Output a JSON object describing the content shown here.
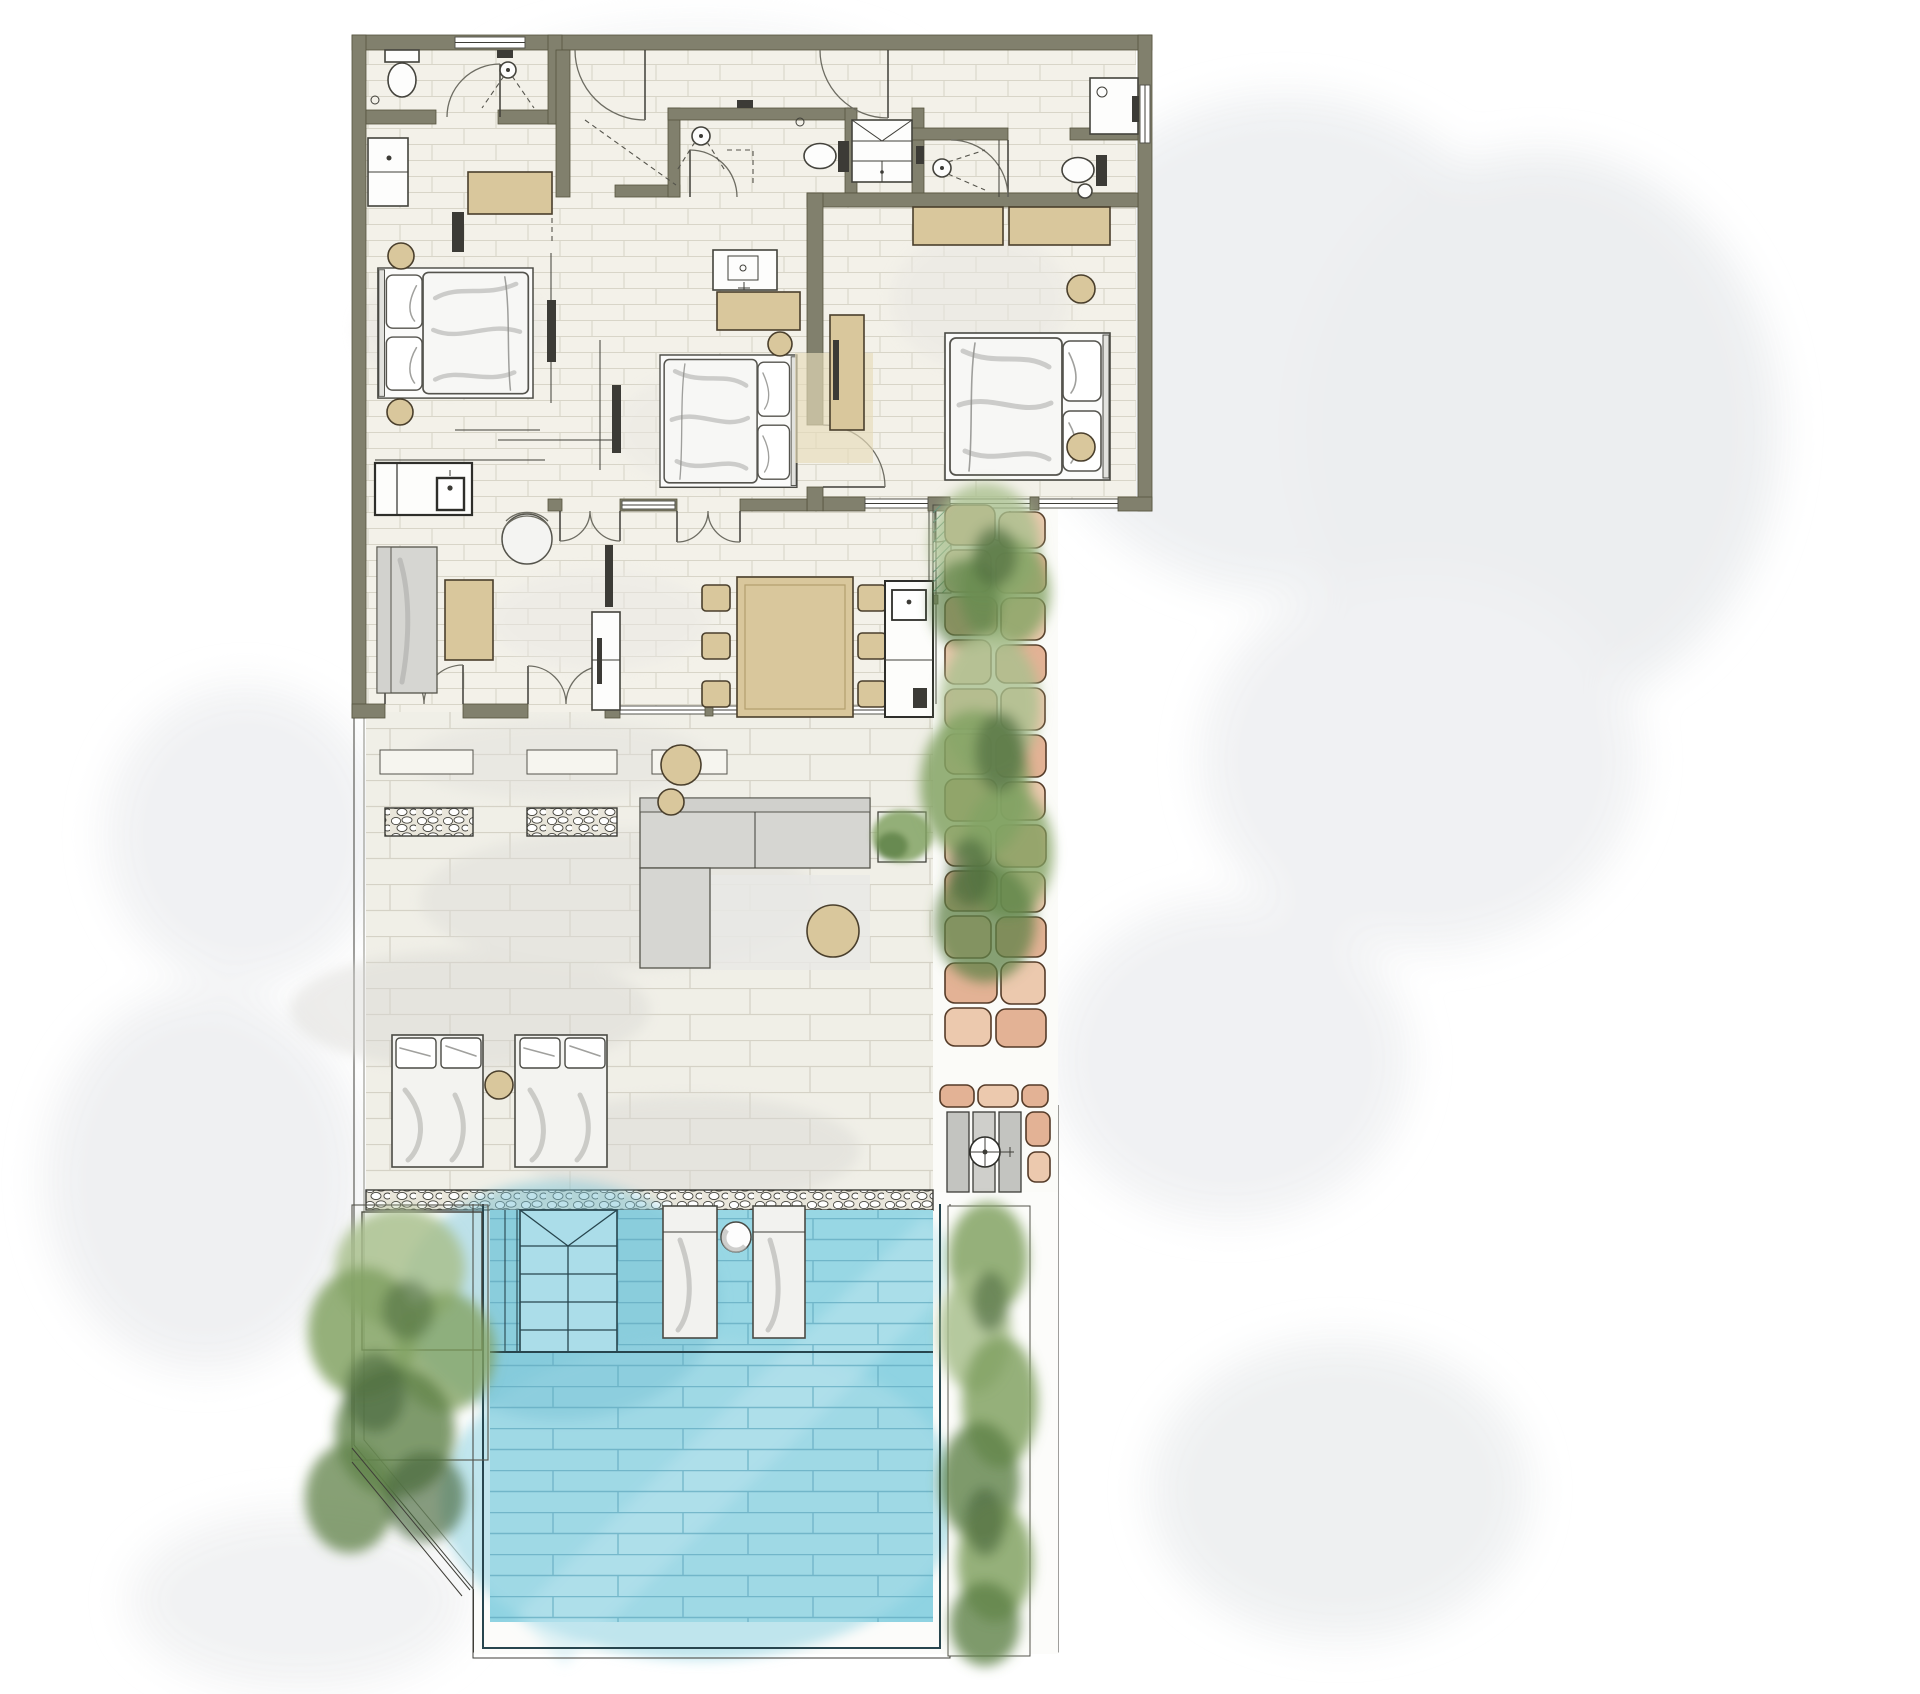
{
  "scene": {
    "type": "architectural-floor-plan",
    "style": "hand-rendered watercolor",
    "view": "top-down plan of a pool villa"
  },
  "colors": {
    "paper": "#ffffff",
    "wash": "#eef0f2",
    "wall": "#81806d",
    "wallEdge": "#55543f",
    "line": "#3f3e38",
    "floor": "#f3f1e9",
    "grout": "#d8d5c8",
    "terrace": "#f0efe7",
    "deck": "#fcfcfa",
    "tan": "#d9c79c",
    "tanLight": "#e7dcba",
    "pool": "#8fd3e2",
    "poolShelf": "#9ad8e5",
    "poolGrout": "#62abc0",
    "poolLine": "#27454e",
    "pebbleBg": "#e9e6db",
    "brick": "#e3b295",
    "brickLight": "#ecc9ae",
    "brickEdge": "#553b28",
    "green1": "#a9bf8d",
    "green2": "#82a263",
    "green3": "#5f8148",
    "green4": "#47663a",
    "hatchTeal": "#4e8b7a",
    "sketchGray": "#a9a9a6"
  },
  "rooms": [
    {
      "id": "bedroom-1",
      "position": "top-left",
      "furniture": [
        "double-bed",
        "bedside-stool",
        "bedside-stool",
        "wardrobe",
        "vanity",
        "tv-panel"
      ]
    },
    {
      "id": "bedroom-2",
      "position": "top-middle",
      "furniture": [
        "double-bed",
        "bedside-stool",
        "vanity-with-sink",
        "wardrobe-cabinet",
        "tv-panel"
      ]
    },
    {
      "id": "bedroom-3",
      "position": "top-right",
      "furniture": [
        "double-bed",
        "bedside-stool",
        "bedside-stool",
        "wardrobe",
        "wardrobe",
        "desk",
        "rug"
      ]
    },
    {
      "id": "bathroom-1",
      "position": "top-left",
      "fixtures": [
        "toilet",
        "shower",
        "swing-door"
      ]
    },
    {
      "id": "bathroom-2",
      "position": "top-middle",
      "fixtures": [
        "toilet",
        "shower",
        "swing-door",
        "linen-closet"
      ]
    },
    {
      "id": "bathroom-3",
      "position": "top-right",
      "fixtures": [
        "toilet",
        "shower",
        "hand-basin",
        "corner-vanity",
        "swing-door"
      ]
    },
    {
      "id": "entry-hall",
      "doors": [
        "entry-door-left",
        "entry-door-right"
      ]
    },
    {
      "id": "living-room",
      "furniture": [
        "sofa",
        "coffee-table",
        "round-armchair",
        "kitchenette-with-sink",
        "media-unit",
        "french-doors",
        "french-doors"
      ]
    },
    {
      "id": "dining-area",
      "furniture": [
        "dining-table",
        "dining-chairs-x6",
        "outdoor-kitchen-counter-with-sink",
        "glazed-wall"
      ]
    }
  ],
  "outdoor": {
    "terrace": [
      "paver-floor",
      "pebble-inlay-band-x3",
      "l-shaped-lounge-sofa",
      "lounge-rug",
      "round-side-table-x3",
      "planter-box",
      "double-sun-lounger-x2",
      "lounger-side-table"
    ],
    "garden_right": [
      "stone-brick-path",
      "shrub-watercolor-cluster-x2",
      "hatched-planting-bed",
      "outdoor-shower-3-slats",
      "shower-rose"
    ],
    "garden_left": [
      "tree-watercolor-cluster",
      "planter-border",
      "diagonal-site-boundary"
    ],
    "pool": {
      "water_color": "#8fd3e2",
      "features": [
        "corner-steps-with-triangle",
        "four-treads",
        "sun-shelf-line",
        "in-pool-lounger-x2",
        "float-ball",
        "tiled-bottom",
        "double-coping-line"
      ],
      "hedge_right": "watercolor-hedge-strip"
    }
  },
  "counts": {
    "beds": 3,
    "toilets": 3,
    "showers": 3,
    "dining_chairs": 6,
    "sun_loungers": 2,
    "in_pool_loungers": 2,
    "door_swing_arcs": 13
  }
}
